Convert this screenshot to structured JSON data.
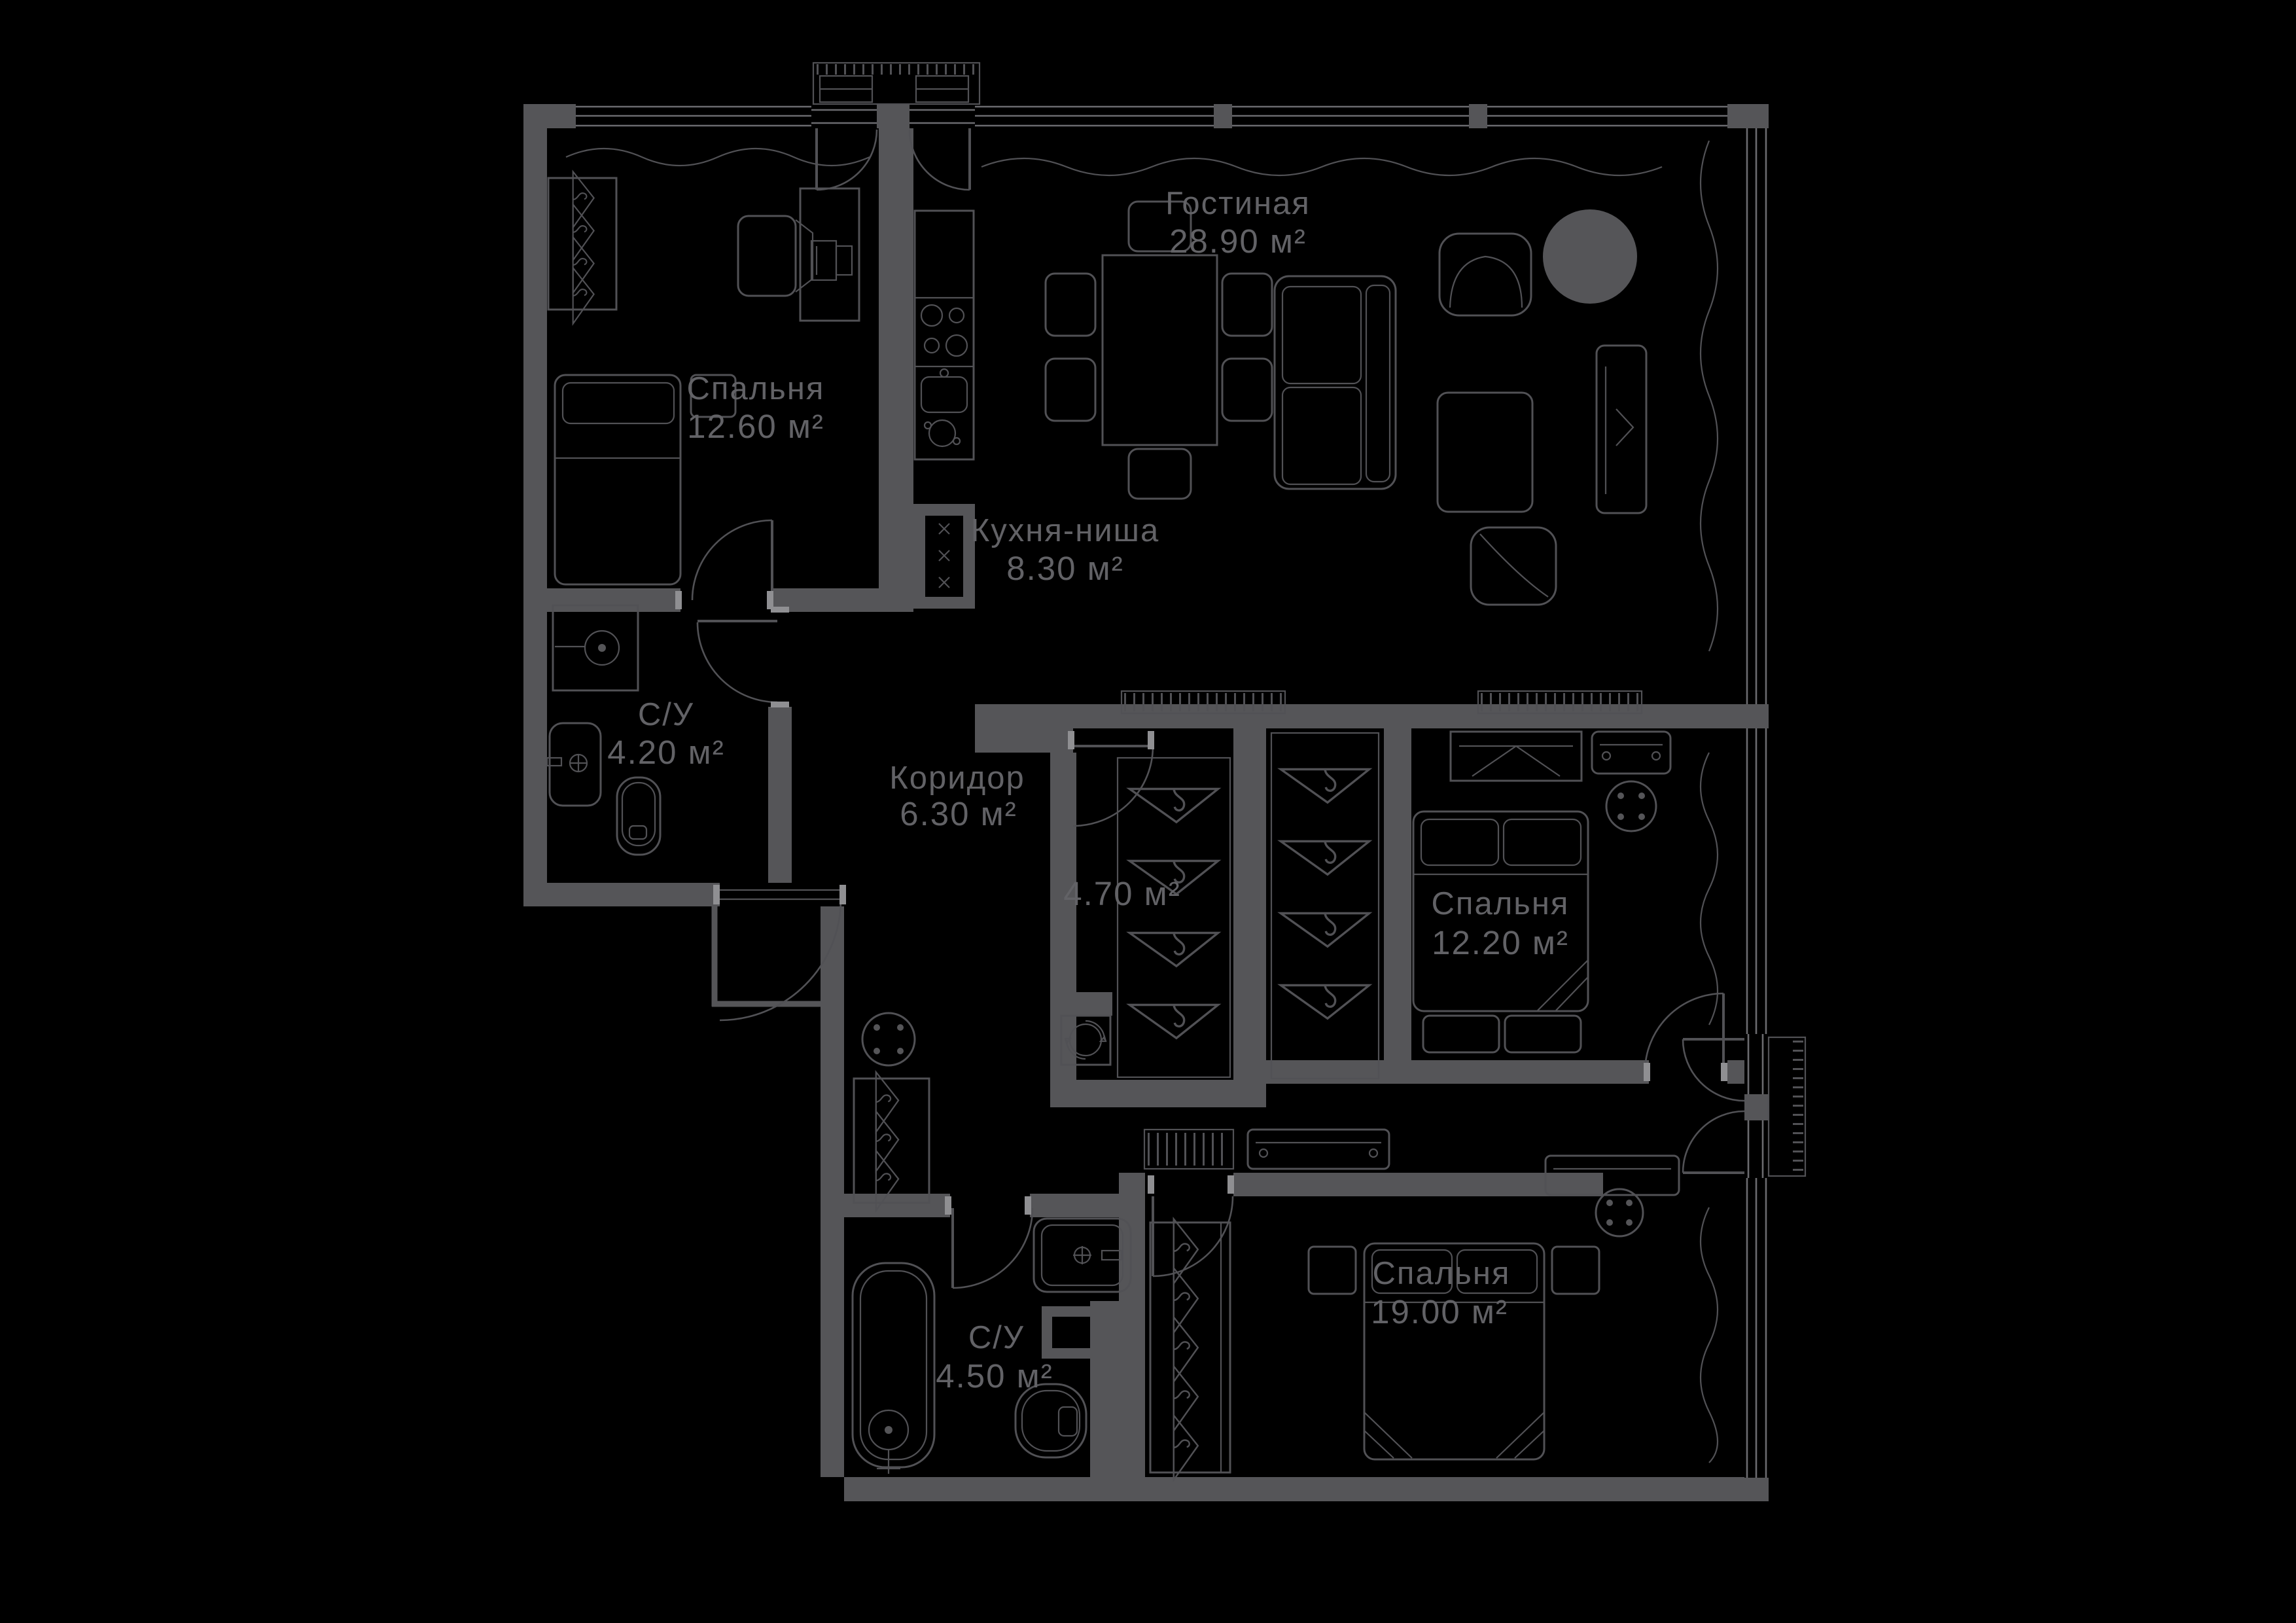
{
  "plan": {
    "type": "apartment-floor-plan",
    "style": "dark",
    "colors": {
      "background": "#000000",
      "wall": "#555558",
      "furniture_line": "#515155",
      "window_line": "#6b6b6f",
      "label_text": "#626266"
    },
    "area_unit": "м²",
    "rooms": [
      {
        "key": "bedroom1",
        "name": "Спальня",
        "area": "12.60 м²"
      },
      {
        "key": "kitchen",
        "name": "Кухня-ниша",
        "area": "8.30 м²"
      },
      {
        "key": "living",
        "name": "Гостиная",
        "area": "28.90 м²"
      },
      {
        "key": "bath1",
        "name": "С/У",
        "area": "4.20 м²"
      },
      {
        "key": "corridor",
        "name": "Коридор",
        "area": "6.30 м²"
      },
      {
        "key": "closet",
        "name": "",
        "area": "4.70 м²"
      },
      {
        "key": "bedroom2",
        "name": "Спальня",
        "area": "12.20 м²"
      },
      {
        "key": "bath2",
        "name": "С/У",
        "area": "4.50 м²"
      },
      {
        "key": "bedroom3",
        "name": "Спальня",
        "area": "19.00 м²"
      }
    ]
  }
}
